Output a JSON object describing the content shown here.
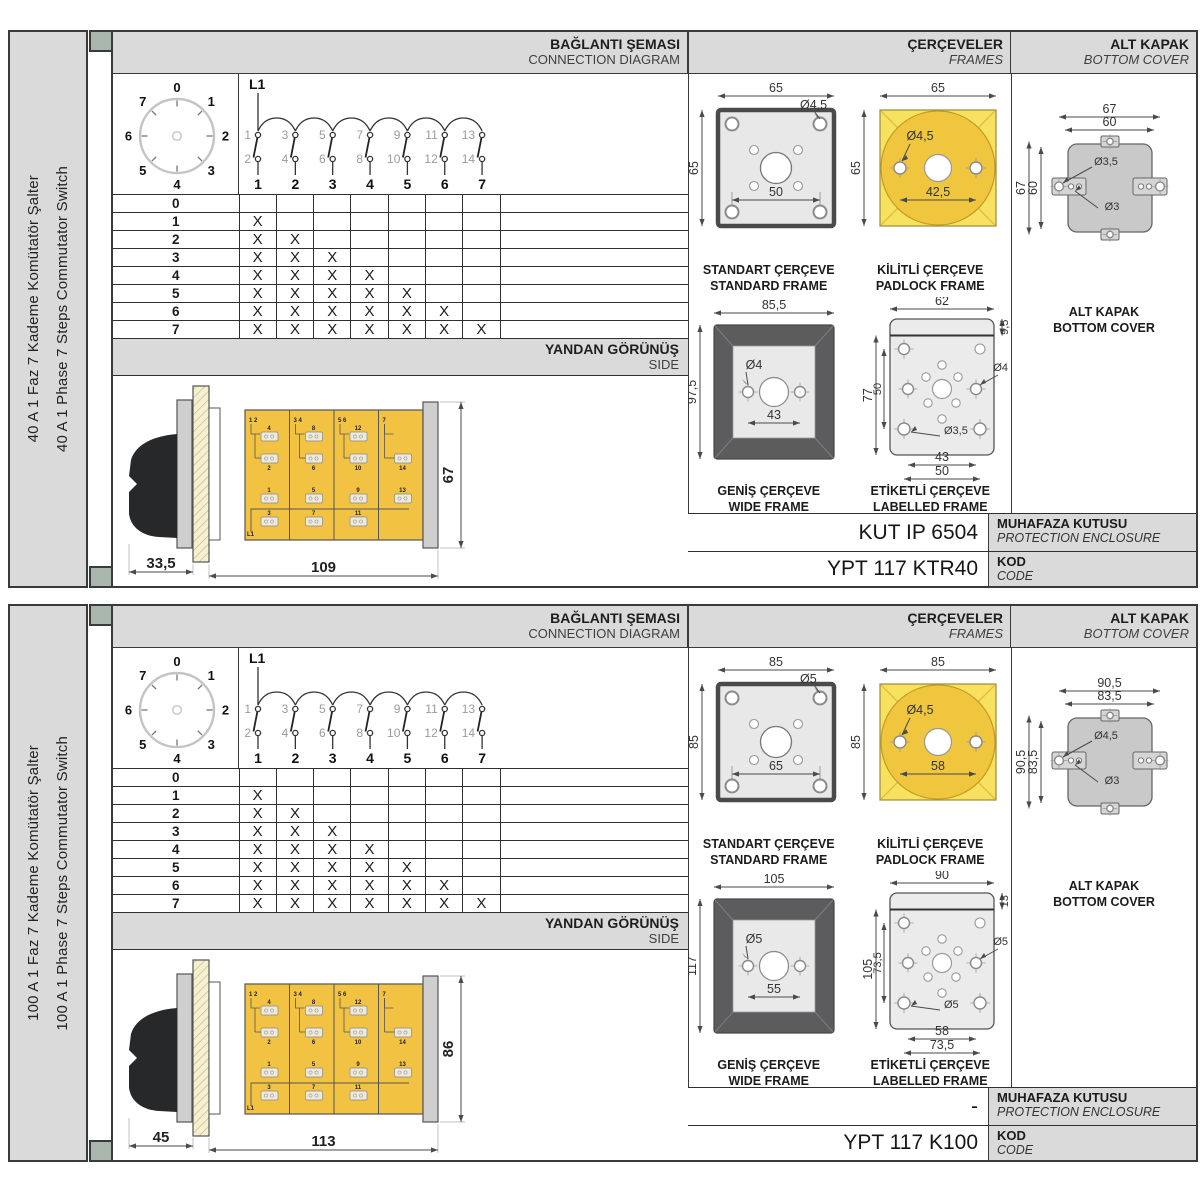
{
  "colors": {
    "panel_gray": "#DADADA",
    "spine_tab": "#A9B6AE",
    "border_dark": "#3A3A3A",
    "body_yellow": "#F2C343",
    "padlock_square_yellow": "#F8E15E",
    "padlock_circle_yellow": "#F0C63E",
    "frame_dark_gray": "#5C5C5E"
  },
  "shared": {
    "mark": "X",
    "dial_numbers": [
      "0",
      "1",
      "2",
      "3",
      "4",
      "5",
      "6",
      "7"
    ],
    "feed_label": "L1",
    "top_terminals": [
      "1",
      "3",
      "5",
      "7",
      "9",
      "11",
      "13"
    ],
    "bottom_terminals": [
      "2",
      "4",
      "6",
      "8",
      "10",
      "12",
      "14"
    ],
    "switch_numbers": [
      "1",
      "2",
      "3",
      "4",
      "5",
      "6",
      "7"
    ],
    "steps": [
      "0",
      "1",
      "2",
      "3",
      "4",
      "5",
      "6",
      "7"
    ]
  },
  "sections": [
    {
      "sidebar_line1": "40 A 1 Faz 7 Kademe Komütatör Şalter",
      "sidebar_line2": "40 A 1 Phase 7 Steps Commutator Switch",
      "headers": {
        "connection_tr": "BAĞLANTI ŞEMASI",
        "connection_en": "CONNECTION DIAGRAM",
        "frames_tr": "ÇERÇEVELER",
        "frames_en": "FRAMES",
        "cover_tr": "ALT KAPAK",
        "cover_en": "BOTTOM COVER",
        "side_tr": "YANDAN GÖRÜNÜŞ",
        "side_en": "SIDE"
      },
      "side_view": {
        "dim_front": "33,5",
        "dim_body": "109",
        "dim_height": "67",
        "l1": "L1",
        "modules": [
          {
            "corner": "1 2",
            "top": [
              "4",
              "2"
            ],
            "bottom": [
              "1",
              "3"
            ]
          },
          {
            "corner": "3 4",
            "top": [
              "8",
              "6"
            ],
            "bottom": [
              "5",
              "7"
            ]
          },
          {
            "corner": "5 6",
            "top": [
              "12",
              "10"
            ],
            "bottom": [
              "9",
              "11"
            ]
          },
          {
            "corner": "7",
            "top": [
              "14"
            ],
            "bottom": [
              "13"
            ]
          }
        ]
      },
      "frames": {
        "standard": {
          "label_tr": "STANDART ÇERÇEVE",
          "label_en": "STANDARD FRAME",
          "dim_w": "65",
          "dim_h": "65",
          "dim_holes": "50",
          "hole_dia": "Ø4,5"
        },
        "padlock": {
          "label_tr": "KİLİTLİ ÇERÇEVE",
          "label_en": "PADLOCK FRAME",
          "dim_w": "65",
          "dim_h": "65",
          "dim_holes": "42,5",
          "hole_dia": "Ø4,5"
        },
        "wide": {
          "label_tr": "GENİŞ ÇERÇEVE",
          "label_en": "WIDE FRAME",
          "dim_w": "85,5",
          "dim_h": "97,5",
          "dim_holes": "43",
          "hole_dia": "Ø4"
        },
        "labelled": {
          "label_tr": "ETİKETLİ ÇERÇEVE",
          "label_en": "LABELLED FRAME",
          "dim_w": "62",
          "dim_strip": "9,5",
          "dim_h": "77",
          "dim_inner_v": "50",
          "dim_holes1": "43",
          "dim_holes2": "50",
          "hole_dia": "Ø4",
          "hole_dia2": "Ø3,5"
        }
      },
      "cover": {
        "label_tr": "ALT KAPAK",
        "label_en": "BOTTOM COVER",
        "dim_outer": "67",
        "dim_inner": "60",
        "dim_outer_v": "67",
        "dim_inner_v": "60",
        "hole_dia": "Ø3,5",
        "hole_dia2": "Ø3"
      },
      "codes": {
        "enclosure_value": "KUT IP 6504",
        "enclosure_tr": "MUHAFAZA KUTUSU",
        "enclosure_en": "PROTECTION ENCLOSURE",
        "code_value": "YPT 117 KTR40",
        "code_tr": "KOD",
        "code_en": "CODE"
      }
    },
    {
      "sidebar_line1": "100 A 1 Faz 7 Kademe Komütatör Şalter",
      "sidebar_line2": "100 A 1 Phase 7 Steps Commutator Switch",
      "headers": {
        "connection_tr": "BAĞLANTI ŞEMASI",
        "connection_en": "CONNECTION DIAGRAM",
        "frames_tr": "ÇERÇEVELER",
        "frames_en": "FRAMES",
        "cover_tr": "ALT KAPAK",
        "cover_en": "BOTTOM COVER",
        "side_tr": "YANDAN GÖRÜNÜŞ",
        "side_en": "SIDE"
      },
      "side_view": {
        "dim_front": "45",
        "dim_body": "113",
        "dim_height": "86",
        "l1": "L1",
        "modules": [
          {
            "corner": "1 2",
            "top": [
              "4",
              "2"
            ],
            "bottom": [
              "1",
              "3"
            ]
          },
          {
            "corner": "3 4",
            "top": [
              "8",
              "6"
            ],
            "bottom": [
              "5",
              "7"
            ]
          },
          {
            "corner": "5 6",
            "top": [
              "12",
              "10"
            ],
            "bottom": [
              "9",
              "11"
            ]
          },
          {
            "corner": "7",
            "top": [
              "14"
            ],
            "bottom": [
              "13"
            ]
          }
        ]
      },
      "frames": {
        "standard": {
          "label_tr": "STANDART ÇERÇEVE",
          "label_en": "STANDARD FRAME",
          "dim_w": "85",
          "dim_h": "85",
          "dim_holes": "65",
          "hole_dia": "Ø5"
        },
        "padlock": {
          "label_tr": "KİLİTLİ ÇERÇEVE",
          "label_en": "PADLOCK FRAME",
          "dim_w": "85",
          "dim_h": "85",
          "dim_holes": "58",
          "hole_dia": "Ø4,5"
        },
        "wide": {
          "label_tr": "GENİŞ ÇERÇEVE",
          "label_en": "WIDE FRAME",
          "dim_w": "105",
          "dim_h": "117",
          "dim_holes": "55",
          "hole_dia": "Ø5"
        },
        "labelled": {
          "label_tr": "ETİKETLİ ÇERÇEVE",
          "label_en": "LABELLED FRAME",
          "dim_w": "90",
          "dim_strip": "13",
          "dim_h": "105",
          "dim_inner_v": "73,5",
          "dim_holes1": "58",
          "dim_holes2": "73,5",
          "hole_dia": "Ø5",
          "hole_dia2": "Ø5"
        }
      },
      "cover": {
        "label_tr": "ALT KAPAK",
        "label_en": "BOTTOM COVER",
        "dim_outer": "90,5",
        "dim_inner": "83,5",
        "dim_outer_v": "90,5",
        "dim_inner_v": "83,5",
        "hole_dia": "Ø4,5",
        "hole_dia2": "Ø3"
      },
      "codes": {
        "enclosure_value": "-",
        "enclosure_tr": "MUHAFAZA KUTUSU",
        "enclosure_en": "PROTECTION ENCLOSURE",
        "code_value": "YPT 117 K100",
        "code_tr": "KOD",
        "code_en": "CODE"
      }
    }
  ]
}
